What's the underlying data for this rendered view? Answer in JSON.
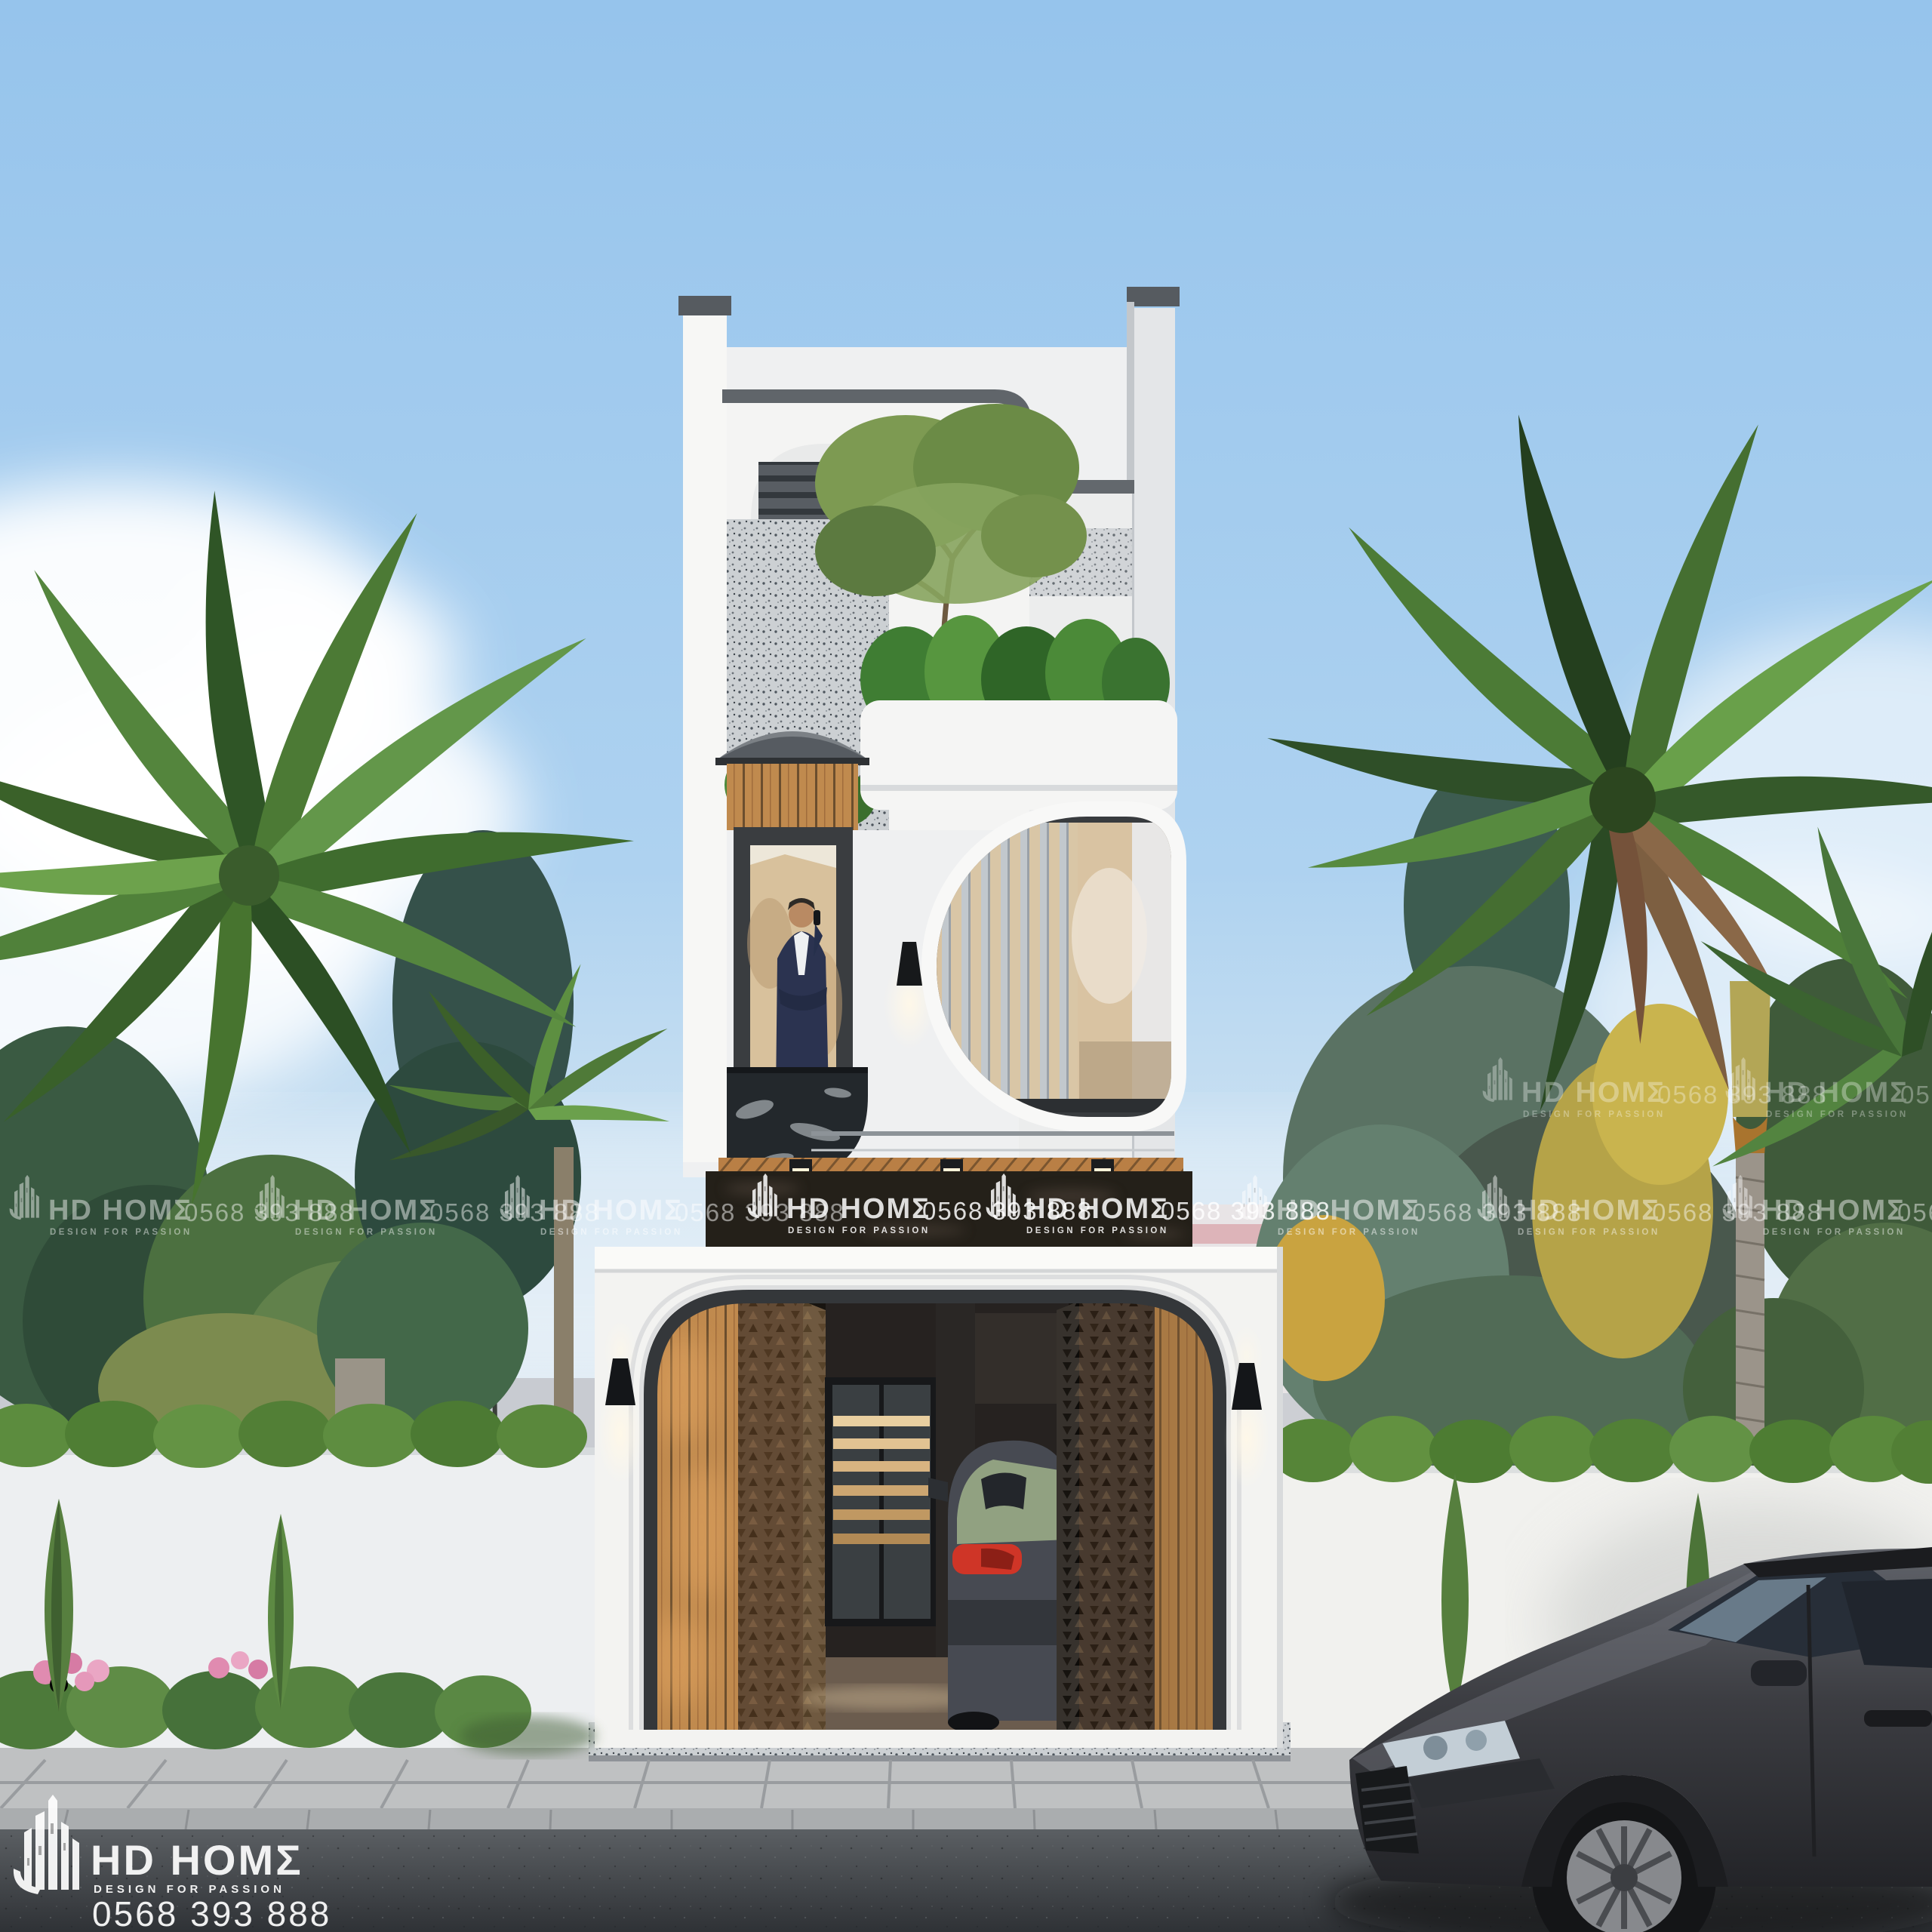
{
  "brand": {
    "name": "HD HOMΣ",
    "tagline": "DESIGN FOR PASSION",
    "phone": "0568 393 888"
  },
  "watermark": {
    "repeated_text": "HD HOMΣ 0568 393 888",
    "color": "#ffffff"
  },
  "colors": {
    "sky_top": "#96c4ec",
    "sky_horizon": "#e6eef5",
    "building_white": "#f3f3f2",
    "coping_gray": "#5c6166",
    "fascia_marble_dark": "#242019",
    "wood_slat": "#c08a4e",
    "terrazzo": "#cdd0d3",
    "hedge_green": "#5c8c3e",
    "palm_green": "#4c7a35",
    "car_foreground_gray": "#3c3d42",
    "taillight_red": "#cf3527",
    "road_asphalt": "#44484c",
    "paver_gray": "#bfc1c2"
  }
}
